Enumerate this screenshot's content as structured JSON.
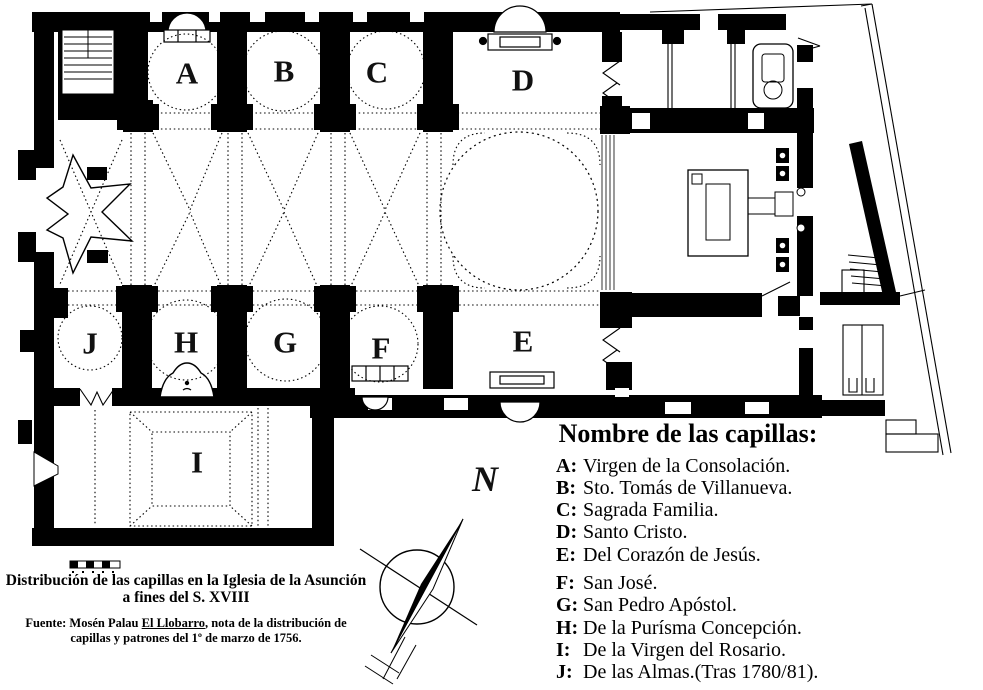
{
  "plan": {
    "chapel_letters": [
      "A",
      "B",
      "C",
      "D",
      "E",
      "F",
      "G",
      "H",
      "I",
      "J"
    ]
  },
  "compass": {
    "north_label": "N"
  },
  "legend": {
    "title": "Nombre de las capillas:",
    "items": [
      {
        "key": "A:",
        "name": "Virgen de la Consolación."
      },
      {
        "key": "B:",
        "name": "Sto. Tomás de Villanueva."
      },
      {
        "key": "C:",
        "name": "Sagrada Familia."
      },
      {
        "key": "D:",
        "name": "Santo Cristo."
      },
      {
        "key": "E:",
        "name": "Del Corazón de Jesús."
      },
      {
        "key": "F:",
        "name": "San José."
      },
      {
        "key": "G:",
        "name": "San Pedro Apóstol."
      },
      {
        "key": "H:",
        "name": "De la Purísma Concepción."
      },
      {
        "key": "I:",
        "name": "De la Virgen del Rosario."
      },
      {
        "key": "J:",
        "name": "De las Almas.(Tras 1780/81)."
      }
    ]
  },
  "caption": {
    "title_line1": "Distribución de las capillas en la Iglesia de la Asunción",
    "title_line2": "a fines del S. XVIII",
    "source_prefix": "Fuente: Mosén Palau ",
    "source_underlined": "El Llobarro",
    "source_suffix": ", nota de la distribución de",
    "source_line2": "capillas y patrones del 1º de marzo de 1756."
  },
  "colors": {
    "ink": "#000000",
    "paper": "#ffffff"
  }
}
